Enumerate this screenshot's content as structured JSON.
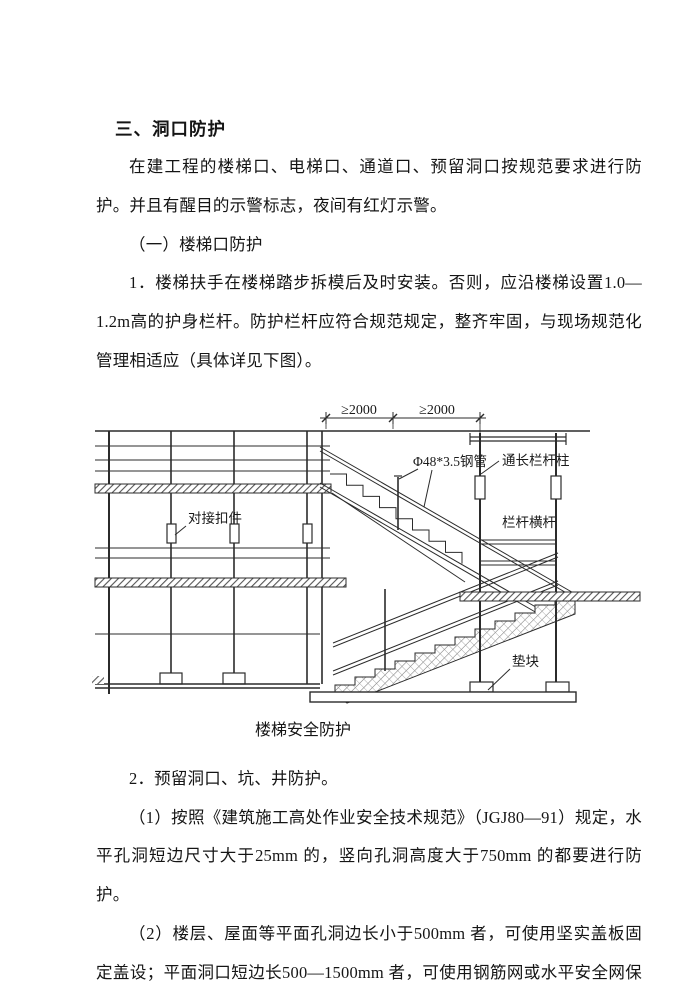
{
  "doc": {
    "heading": "三、洞口防护",
    "intro": "在建工程的楼梯口、电梯口、通道口、预留洞口按规范要求进行防护。并且有醒目的示警标志，夜间有红灯示警。",
    "sub1": "（一）楼梯口防护",
    "item1": "1．楼梯扶手在楼梯踏步拆模后及时安装。否则，应沿楼梯设置1.0—1.2m高的护身栏杆。防护栏杆应符合规范规定，整齐牢固，与现场规范化管理相适应（具体详见下图）。",
    "caption": "楼梯安全防护",
    "item2": "2．预留洞口、坑、井防护。",
    "item2_1": "（1）按照《建筑施工高处作业安全技术规范》（JGJ80—91）规定，水平孔洞短边尺寸大于25mm 的，竖向孔洞高度大于750mm 的都要进行防护。",
    "item2_2": "（2）楼层、屋面等平面孔洞边长小于500mm 者，可使用坚实盖板固定盖设；平面洞口短边长500—1500mm 者，可使用钢筋网或水平安全网保护，上"
  },
  "diagram": {
    "dim_left": "≥2000",
    "dim_right": "≥2000",
    "label_steel_pipe": "Φ48*3.5钢管",
    "label_rail_post": "通长栏杆柱",
    "label_coupler": "对接扣件",
    "label_rail_bar": "栏杆横杆",
    "label_pad": "垫块"
  },
  "colors": {
    "ink": "#2b2b2b",
    "paper": "#ffffff"
  }
}
